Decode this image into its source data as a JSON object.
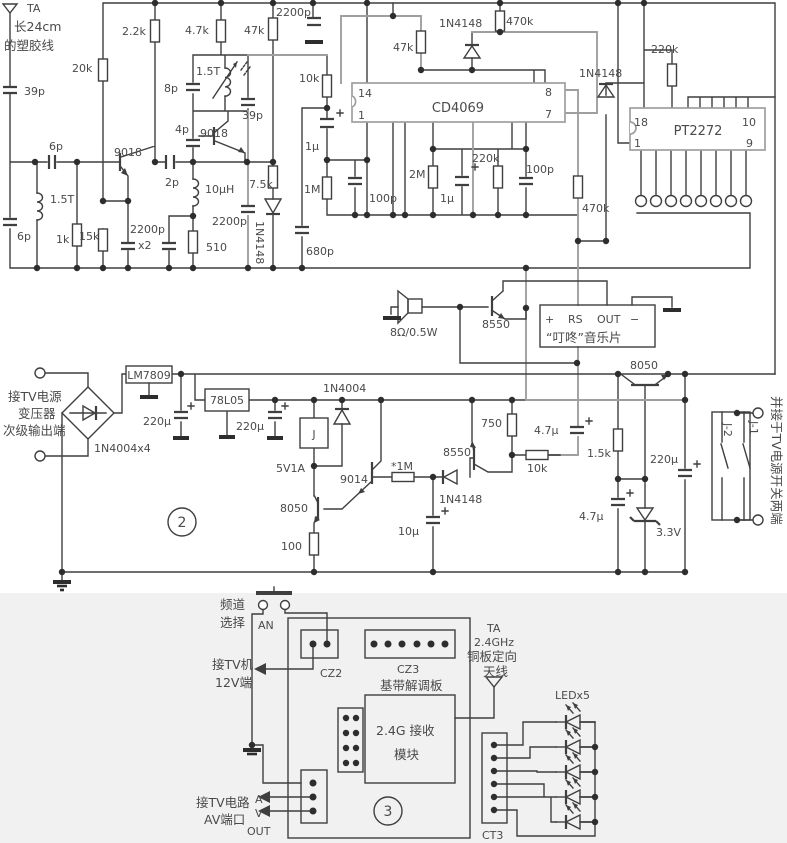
{
  "figure": {
    "type": "circuit-schematic",
    "description_visible_panels": [
      "2",
      "3"
    ],
    "colors": {
      "ink": "#3f3f3f",
      "ink_light": "#9f9f9f",
      "background": "#ffffff",
      "lower_band": "#f1f1f1"
    }
  },
  "labels": [
    {
      "id": "ant1-name",
      "x": 27,
      "y": 12,
      "t": "TA"
    },
    {
      "id": "ant1-note1",
      "x": 14,
      "y": 31,
      "t": "长24cm",
      "zh": 1,
      "fs": 12.5
    },
    {
      "id": "ant1-note2",
      "x": 4,
      "y": 50,
      "t": "的塑胶线",
      "zh": 1,
      "fs": 12.5
    },
    {
      "id": "c39p-a",
      "x": 24,
      "y": 95,
      "t": "39p"
    },
    {
      "id": "c6p-a",
      "x": 49,
      "y": 150,
      "t": "6p"
    },
    {
      "id": "l1-5t-a",
      "x": 50,
      "y": 203,
      "t": "1.5T"
    },
    {
      "id": "c6p-b",
      "x": 17,
      "y": 240,
      "t": "6p"
    },
    {
      "id": "r1k",
      "x": 56,
      "y": 243,
      "t": "1k"
    },
    {
      "id": "r15k",
      "x": 79,
      "y": 240,
      "t": "15k"
    },
    {
      "id": "r20k",
      "x": 72,
      "y": 72,
      "t": "20k"
    },
    {
      "id": "q1",
      "x": 114,
      "y": 156,
      "t": "9018"
    },
    {
      "id": "r2k2",
      "x": 122,
      "y": 35,
      "t": "2.2k"
    },
    {
      "id": "c2200p-a",
      "x": 130,
      "y": 233,
      "t": "2200p"
    },
    {
      "id": "c2200p-x2",
      "x": 138,
      "y": 249,
      "t": "x2"
    },
    {
      "id": "c2p",
      "x": 165,
      "y": 186,
      "t": "2p"
    },
    {
      "id": "c4p",
      "x": 175,
      "y": 133,
      "t": "4p"
    },
    {
      "id": "c8p",
      "x": 164,
      "y": 92,
      "t": "8p"
    },
    {
      "id": "l1-5t-b",
      "x": 196,
      "y": 75,
      "t": "1.5T"
    },
    {
      "id": "q2",
      "x": 200,
      "y": 137,
      "t": "9018"
    },
    {
      "id": "r4k7",
      "x": 185,
      "y": 34,
      "t": "4.7k"
    },
    {
      "id": "c39p-b",
      "x": 242,
      "y": 119,
      "t": "39p"
    },
    {
      "id": "l10uh",
      "x": 205,
      "y": 193,
      "t": "10μH"
    },
    {
      "id": "r510",
      "x": 206,
      "y": 251,
      "t": "510"
    },
    {
      "id": "c2200p-b",
      "x": 212,
      "y": 225,
      "t": "2200p"
    },
    {
      "id": "r47k-a",
      "x": 244,
      "y": 34,
      "t": "47k"
    },
    {
      "id": "c2200p-top",
      "x": 276,
      "y": 16,
      "t": "2200p"
    },
    {
      "id": "r7k5",
      "x": 249,
      "y": 188,
      "t": "7.5k"
    },
    {
      "id": "d4148-a",
      "x": 256,
      "y": 221,
      "t": "1N4148",
      "r": 90
    },
    {
      "id": "c680p",
      "x": 306,
      "y": 255,
      "t": "680p"
    },
    {
      "id": "r10k-a",
      "x": 299,
      "y": 82,
      "t": "10k"
    },
    {
      "id": "c1u-a",
      "x": 305,
      "y": 150,
      "t": "1μ"
    },
    {
      "id": "r1m",
      "x": 304,
      "y": 193,
      "t": "1M"
    },
    {
      "id": "c100p-a",
      "x": 369,
      "y": 202,
      "t": "100p"
    },
    {
      "id": "ic-cd4069",
      "x": 458,
      "y": 112,
      "t": "CD4069",
      "a": "mid",
      "fs": 13
    },
    {
      "id": "pin14",
      "x": 358,
      "y": 97,
      "t": "14"
    },
    {
      "id": "pin1",
      "x": 358,
      "y": 119,
      "t": "1"
    },
    {
      "id": "pin8",
      "x": 545,
      "y": 96,
      "t": "8"
    },
    {
      "id": "pin7",
      "x": 545,
      "y": 118,
      "t": "7"
    },
    {
      "id": "r47k-b",
      "x": 393,
      "y": 51,
      "t": "47k"
    },
    {
      "id": "d4148-b",
      "x": 439,
      "y": 27,
      "t": "1N4148"
    },
    {
      "id": "r470k-a",
      "x": 506,
      "y": 25,
      "t": "470k"
    },
    {
      "id": "r2m",
      "x": 409,
      "y": 178,
      "t": "2M"
    },
    {
      "id": "c1u-b",
      "x": 440,
      "y": 202,
      "t": "1μ"
    },
    {
      "id": "r220k-a",
      "x": 472,
      "y": 162,
      "t": "220k"
    },
    {
      "id": "c100p-b",
      "x": 526,
      "y": 173,
      "t": "100p"
    },
    {
      "id": "r470k-b",
      "x": 582,
      "y": 212,
      "t": "470k"
    },
    {
      "id": "d4148-c",
      "x": 579,
      "y": 77,
      "t": "1N4148"
    },
    {
      "id": "r220k-b",
      "x": 651,
      "y": 53,
      "t": "220k"
    },
    {
      "id": "ic-pt2272",
      "x": 698,
      "y": 135,
      "t": "PT2272",
      "a": "mid",
      "fs": 13
    },
    {
      "id": "pin18",
      "x": 634,
      "y": 126,
      "t": "18"
    },
    {
      "id": "pin1b",
      "x": 634,
      "y": 147,
      "t": "1"
    },
    {
      "id": "pin10",
      "x": 742,
      "y": 126,
      "t": "10"
    },
    {
      "id": "pin9",
      "x": 746,
      "y": 147,
      "t": "9"
    },
    {
      "id": "speaker-rating",
      "x": 390,
      "y": 336,
      "t": "8Ω/0.5W"
    },
    {
      "id": "q3",
      "x": 482,
      "y": 328,
      "t": "8550"
    },
    {
      "id": "music-plus",
      "x": 545,
      "y": 323,
      "t": "+"
    },
    {
      "id": "music-rs",
      "x": 568,
      "y": 323,
      "t": "RS"
    },
    {
      "id": "music-out",
      "x": 597,
      "y": 323,
      "t": "OUT"
    },
    {
      "id": "music-minus",
      "x": 630,
      "y": 323,
      "t": "−"
    },
    {
      "id": "music-name",
      "x": 546,
      "y": 342,
      "t": "“叮咚”音乐片",
      "zh": 1,
      "fs": 12.5
    },
    {
      "id": "in-note1",
      "x": 8,
      "y": 401,
      "t": "接TV电源",
      "zh": 1,
      "fs": 12.5
    },
    {
      "id": "in-note2",
      "x": 18,
      "y": 418,
      "t": "变压器",
      "zh": 1,
      "fs": 12.5
    },
    {
      "id": "in-note3",
      "x": 3,
      "y": 435,
      "t": "次级输出端",
      "zh": 1,
      "fs": 12.5
    },
    {
      "id": "bridge",
      "x": 94,
      "y": 452,
      "t": "1N4004x4"
    },
    {
      "id": "reg-lm7809",
      "x": 149,
      "y": 379,
      "t": "LM7809",
      "a": "mid"
    },
    {
      "id": "c220u-a",
      "x": 143,
      "y": 425,
      "t": "220μ"
    },
    {
      "id": "reg-78l05",
      "x": 227,
      "y": 404,
      "t": "78L05",
      "a": "mid"
    },
    {
      "id": "c220u-b",
      "x": 236,
      "y": 430,
      "t": "220μ"
    },
    {
      "id": "d4004",
      "x": 323,
      "y": 392,
      "t": "1N4004"
    },
    {
      "id": "relay-j",
      "x": 314,
      "y": 438,
      "t": "J",
      "a": "mid"
    },
    {
      "id": "relay-rating",
      "x": 276,
      "y": 472,
      "t": "5V1A"
    },
    {
      "id": "q5",
      "x": 340,
      "y": 483,
      "t": "9014"
    },
    {
      "id": "r1m-star",
      "x": 391,
      "y": 470,
      "t": "*1M"
    },
    {
      "id": "q6",
      "x": 443,
      "y": 456,
      "t": "8550"
    },
    {
      "id": "d4148-d",
      "x": 439,
      "y": 503,
      "t": "1N4148"
    },
    {
      "id": "r750",
      "x": 481,
      "y": 427,
      "t": "750"
    },
    {
      "id": "r10k-b",
      "x": 527,
      "y": 472,
      "t": "10k"
    },
    {
      "id": "c4u7-a",
      "x": 534,
      "y": 434,
      "t": "4.7μ"
    },
    {
      "id": "r1k5",
      "x": 587,
      "y": 457,
      "t": "1.5k"
    },
    {
      "id": "c220u-c",
      "x": 650,
      "y": 463,
      "t": "220μ"
    },
    {
      "id": "c4u7-b",
      "x": 579,
      "y": 520,
      "t": "4.7μ"
    },
    {
      "id": "zener",
      "x": 656,
      "y": 536,
      "t": "3.3V"
    },
    {
      "id": "q7",
      "x": 280,
      "y": 512,
      "t": "8050"
    },
    {
      "id": "r100",
      "x": 281,
      "y": 550,
      "t": "100"
    },
    {
      "id": "c10u",
      "x": 398,
      "y": 535,
      "t": "10μ"
    },
    {
      "id": "q8",
      "x": 630,
      "y": 369,
      "t": "8050"
    },
    {
      "id": "marker-2",
      "x": 182,
      "y": 527,
      "t": "2",
      "a": "mid",
      "fs": 14
    },
    {
      "id": "j2",
      "x": 724,
      "y": 423,
      "t": "J-2",
      "r": 90
    },
    {
      "id": "j1",
      "x": 750,
      "y": 421,
      "t": "J-1",
      "r": 90
    },
    {
      "id": "note-right",
      "x": 772,
      "y": 396,
      "t": "并接于TV电源开关两端",
      "zh": 1,
      "fs": 12.5,
      "r": 90
    },
    {
      "id": "ch-note1",
      "x": 220,
      "y": 609,
      "t": "频道",
      "zh": 1,
      "fs": 12.5
    },
    {
      "id": "ch-note2",
      "x": 220,
      "y": 627,
      "t": "选择",
      "zh": 1,
      "fs": 12.5
    },
    {
      "id": "btn-an",
      "x": 258,
      "y": 629,
      "t": "AN"
    },
    {
      "id": "cz2",
      "x": 320,
      "y": 677,
      "t": "CZ2"
    },
    {
      "id": "cz3",
      "x": 397,
      "y": 673,
      "t": "CZ3"
    },
    {
      "id": "board-name",
      "x": 380,
      "y": 690,
      "t": "基带解调板",
      "zh": 1,
      "fs": 12.5
    },
    {
      "id": "module-1",
      "x": 376,
      "y": 735,
      "t": "2.4G 接收",
      "zh": 1,
      "fs": 12.5
    },
    {
      "id": "module-2",
      "x": 394,
      "y": 759,
      "t": "模块",
      "zh": 1,
      "fs": 12.5
    },
    {
      "id": "tv12-1",
      "x": 212,
      "y": 669,
      "t": "接TV机",
      "zh": 1,
      "fs": 12.5
    },
    {
      "id": "tv12-2",
      "x": 215,
      "y": 687,
      "t": "12V端",
      "zh": 1,
      "fs": 12.5
    },
    {
      "id": "av-1",
      "x": 196,
      "y": 807,
      "t": "接TV电路",
      "zh": 1,
      "fs": 12.5
    },
    {
      "id": "av-2",
      "x": 204,
      "y": 824,
      "t": "AV端口",
      "zh": 1,
      "fs": 12.5
    },
    {
      "id": "av-a",
      "x": 255,
      "y": 803,
      "t": "A"
    },
    {
      "id": "av-v",
      "x": 255,
      "y": 817,
      "t": "V"
    },
    {
      "id": "av-out",
      "x": 247,
      "y": 835,
      "t": "OUT"
    },
    {
      "id": "ant2-1",
      "x": 487,
      "y": 632,
      "t": "TA"
    },
    {
      "id": "ant2-2",
      "x": 474,
      "y": 646,
      "t": "2.4GHz"
    },
    {
      "id": "ant2-3",
      "x": 467,
      "y": 661,
      "t": "铜板定向",
      "zh": 1,
      "fs": 12.5
    },
    {
      "id": "ant2-4",
      "x": 483,
      "y": 676,
      "t": "天线",
      "zh": 1,
      "fs": 12.5
    },
    {
      "id": "led-x5",
      "x": 555,
      "y": 699,
      "t": "LEDx5"
    },
    {
      "id": "ct3",
      "x": 482,
      "y": 839,
      "t": "CT3"
    },
    {
      "id": "marker-3",
      "x": 388,
      "y": 816,
      "t": "3",
      "a": "mid",
      "fs": 14
    }
  ]
}
